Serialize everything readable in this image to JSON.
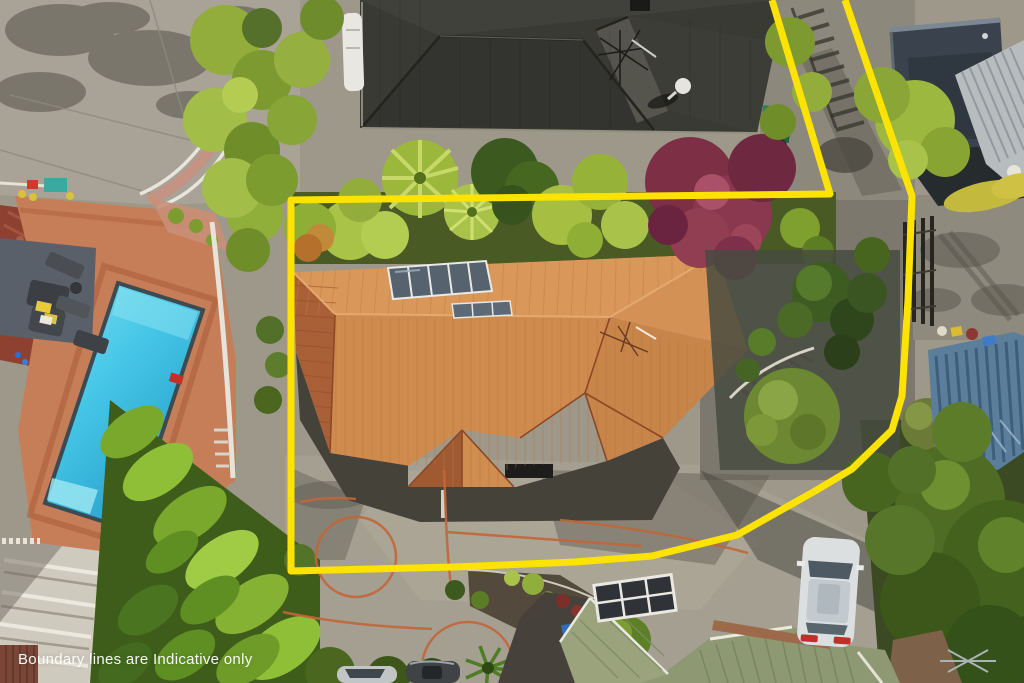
{
  "meta": {
    "title": "Aerial drone photo of residential property with boundary overlay",
    "width": 1024,
    "height": 683
  },
  "overlay": {
    "disclaimer": "Boundary lines are Indicative only",
    "boundary": {
      "color": "#ffe300",
      "stroke_width": 7,
      "polyline": [
        [
          772,
          0
        ],
        [
          830,
          194
        ],
        [
          291,
          200
        ],
        [
          291,
          571
        ],
        [
          455,
          567
        ],
        [
          575,
          562
        ],
        [
          652,
          556
        ],
        [
          737,
          535
        ],
        [
          815,
          491
        ],
        [
          852,
          469
        ],
        [
          892,
          430
        ],
        [
          902,
          396
        ],
        [
          908,
          300
        ],
        [
          912,
          196
        ],
        [
          845,
          0
        ]
      ]
    }
  },
  "scene": {
    "features": [
      "main-house-orange-tile-roof",
      "swimming-pool",
      "pool-patio",
      "neighbor-dark-roof-top",
      "neighbor-roofs-top-right",
      "cypress-hedge-left",
      "red-maple-tree",
      "tree-ferns",
      "driveway-courtyard",
      "orange-court-markings",
      "bottom-house-green-roof",
      "white-station-wagon",
      "parked-cars-bottom",
      "garden-round-bushes",
      "driveway-gate",
      "blue-louver-carport",
      "wheelie-bins"
    ],
    "colors": {
      "boundary_yellow": "#ffe300",
      "pool_water": "#45c6e6",
      "main_roof_lit": "#d9985a",
      "main_roof_shade": "#aa6036",
      "neighbor_roof_dark": "#3a3a35",
      "concrete": "#a29c8f",
      "foliage_bright": "#9cb83c",
      "foliage_dark": "#3f5c1e",
      "red_tree": "#7c2f45"
    }
  }
}
